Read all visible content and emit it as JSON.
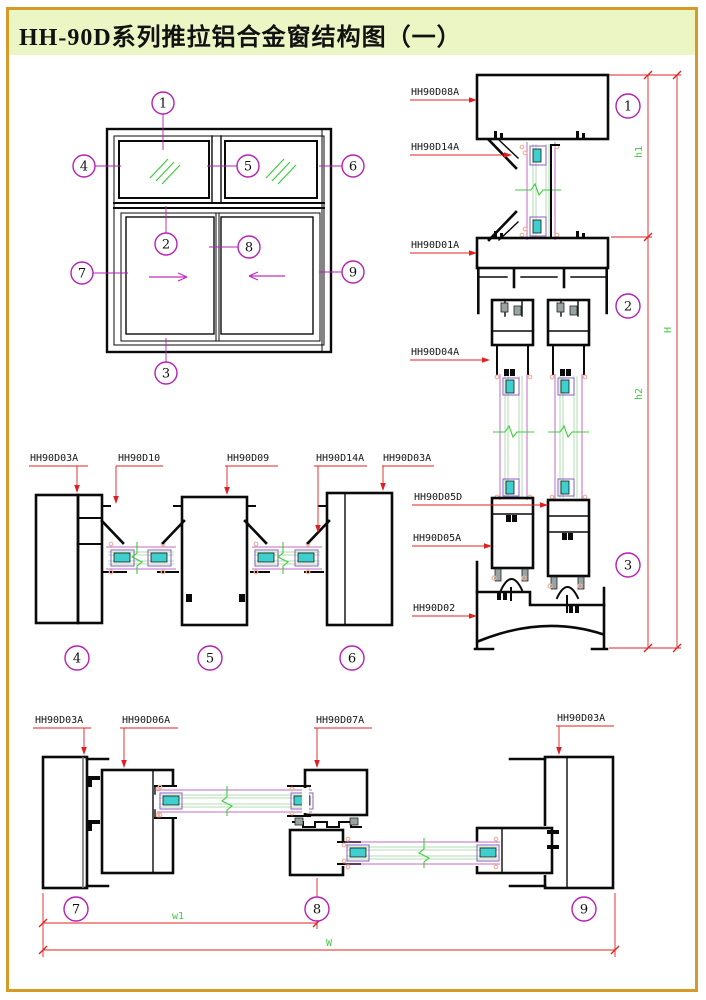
{
  "page": {
    "title": "HH-90D系列推拉铝合金窗结构图（一）"
  },
  "colors": {
    "page_border": "#D79A26",
    "title_background": "#ECF5C4",
    "drawing_line": "#0A0A0A",
    "leader_red": "#E02020",
    "callout_magenta": "#B520B5",
    "dimension_green": "#3ECC3E",
    "glass_outline_magenta": "#C468C4",
    "glass_pane_green": "#B2DDB2",
    "glazing_block_cyan": "#3FCFCF",
    "gasket_pink": "#F2B49B",
    "weatherstrip_gray": "#98A4A4"
  },
  "elevation": {
    "callouts": [
      "1",
      "2",
      "3",
      "4",
      "5",
      "6",
      "7",
      "8",
      "9"
    ]
  },
  "vsection": {
    "labels": [
      "HH90D08A",
      "HH90D14A",
      "HH90D01A",
      "HH90D04A",
      "HH90D05D",
      "HH90D05A",
      "HH90D02"
    ],
    "callouts": [
      "1",
      "2",
      "3"
    ],
    "dims": {
      "h1": "h1",
      "h2": "h2",
      "H": "H"
    }
  },
  "midsection": {
    "labels": [
      "HH90D03A",
      "HH90D10",
      "HH90D09",
      "HH90D14A",
      "HH90D03A"
    ],
    "callouts": [
      "4",
      "5",
      "6"
    ]
  },
  "bottomsection": {
    "labels": [
      "HH90D03A",
      "HH90D06A",
      "HH90D07A",
      "HH90D03A"
    ],
    "callouts": [
      "7",
      "8",
      "9"
    ],
    "dims": {
      "w1": "w1",
      "W": "W"
    }
  }
}
